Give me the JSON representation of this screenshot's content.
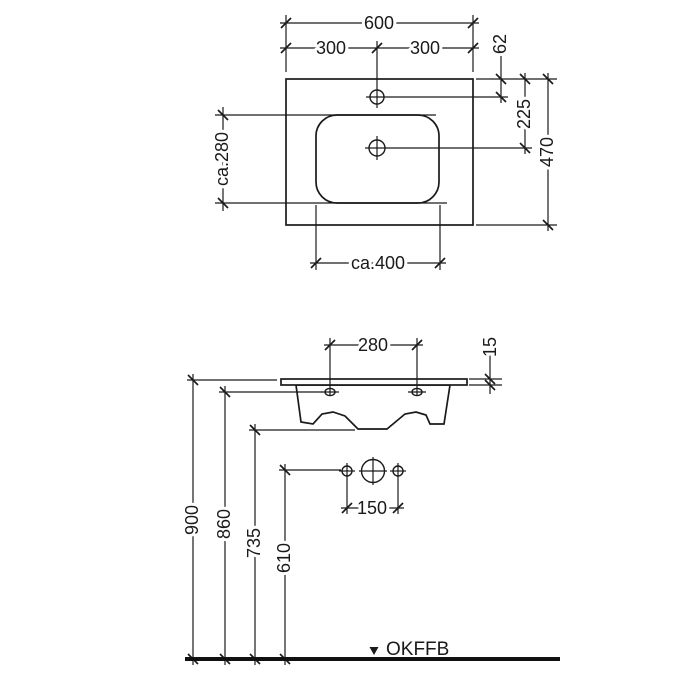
{
  "drawing": {
    "type": "washbasin technical dimension drawing",
    "colors": {
      "line": "#1a1a1a",
      "floor_line": "#111111",
      "background": "#ffffff"
    },
    "top_view": {
      "width_total": "600",
      "width_left": "300",
      "width_right": "300",
      "faucet_hole_offset": "62",
      "drain_offset": "225",
      "depth_total": "470",
      "bowl_depth": "ca.280",
      "bowl_width": "ca.400"
    },
    "front_view": {
      "mounting_hole_spacing": "280",
      "rim_thickness": "15",
      "connection_spacing": "150",
      "height_rim": "900",
      "height_mounting": "860",
      "height_underside": "735",
      "height_connections": "610",
      "floor_label": "OKFFB"
    }
  }
}
